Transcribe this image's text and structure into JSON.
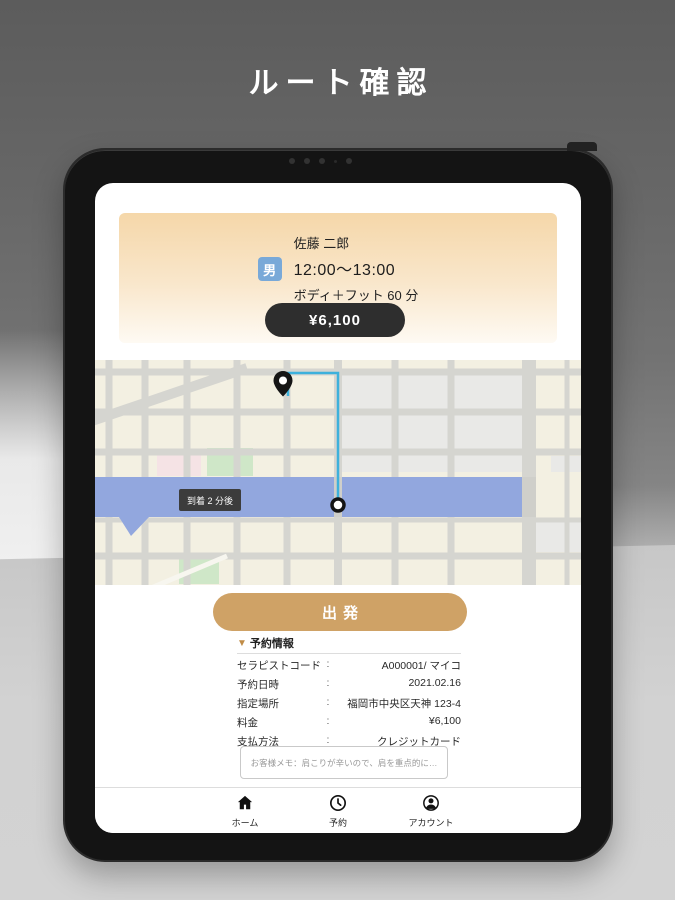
{
  "page": {
    "title": "ルート確認"
  },
  "booking_card": {
    "customer_name": "佐藤 二郎",
    "gender_badge": "男",
    "time_range": "12:00〜13:00",
    "service": "ボディ＋フット 60 分",
    "price": "¥6,100"
  },
  "map": {
    "arrival_tooltip": "到着 2 分後"
  },
  "actions": {
    "depart_label": "出発"
  },
  "reservation": {
    "marker": "▼",
    "header": "予約情報",
    "colon": ":",
    "rows": [
      {
        "label": "セラピストコード",
        "value": "A000001/ マイコ"
      },
      {
        "label": "予約日時",
        "value": "2021.02.16"
      },
      {
        "label": "指定場所",
        "value": "福岡市中央区天神 123-4"
      },
      {
        "label": "料金",
        "value": "¥6,100"
      },
      {
        "label": "支払方法",
        "value": "クレジットカード"
      }
    ],
    "memo": "お客様メモ：肩こりが辛いので、肩を重点的に…"
  },
  "tab_bar": {
    "items": [
      {
        "label": "ホーム",
        "active": true
      },
      {
        "label": "予約",
        "active": false
      },
      {
        "label": "アカウント",
        "active": false
      }
    ]
  },
  "colors": {
    "accent_gold": "#cfa266",
    "badge_blue": "#79a9d8",
    "price_pill_dark": "#2e2e2e",
    "river_blue": "#92a7de",
    "route_teal": "#3db1dc",
    "card_gradient_top": "#f5d7a9"
  }
}
